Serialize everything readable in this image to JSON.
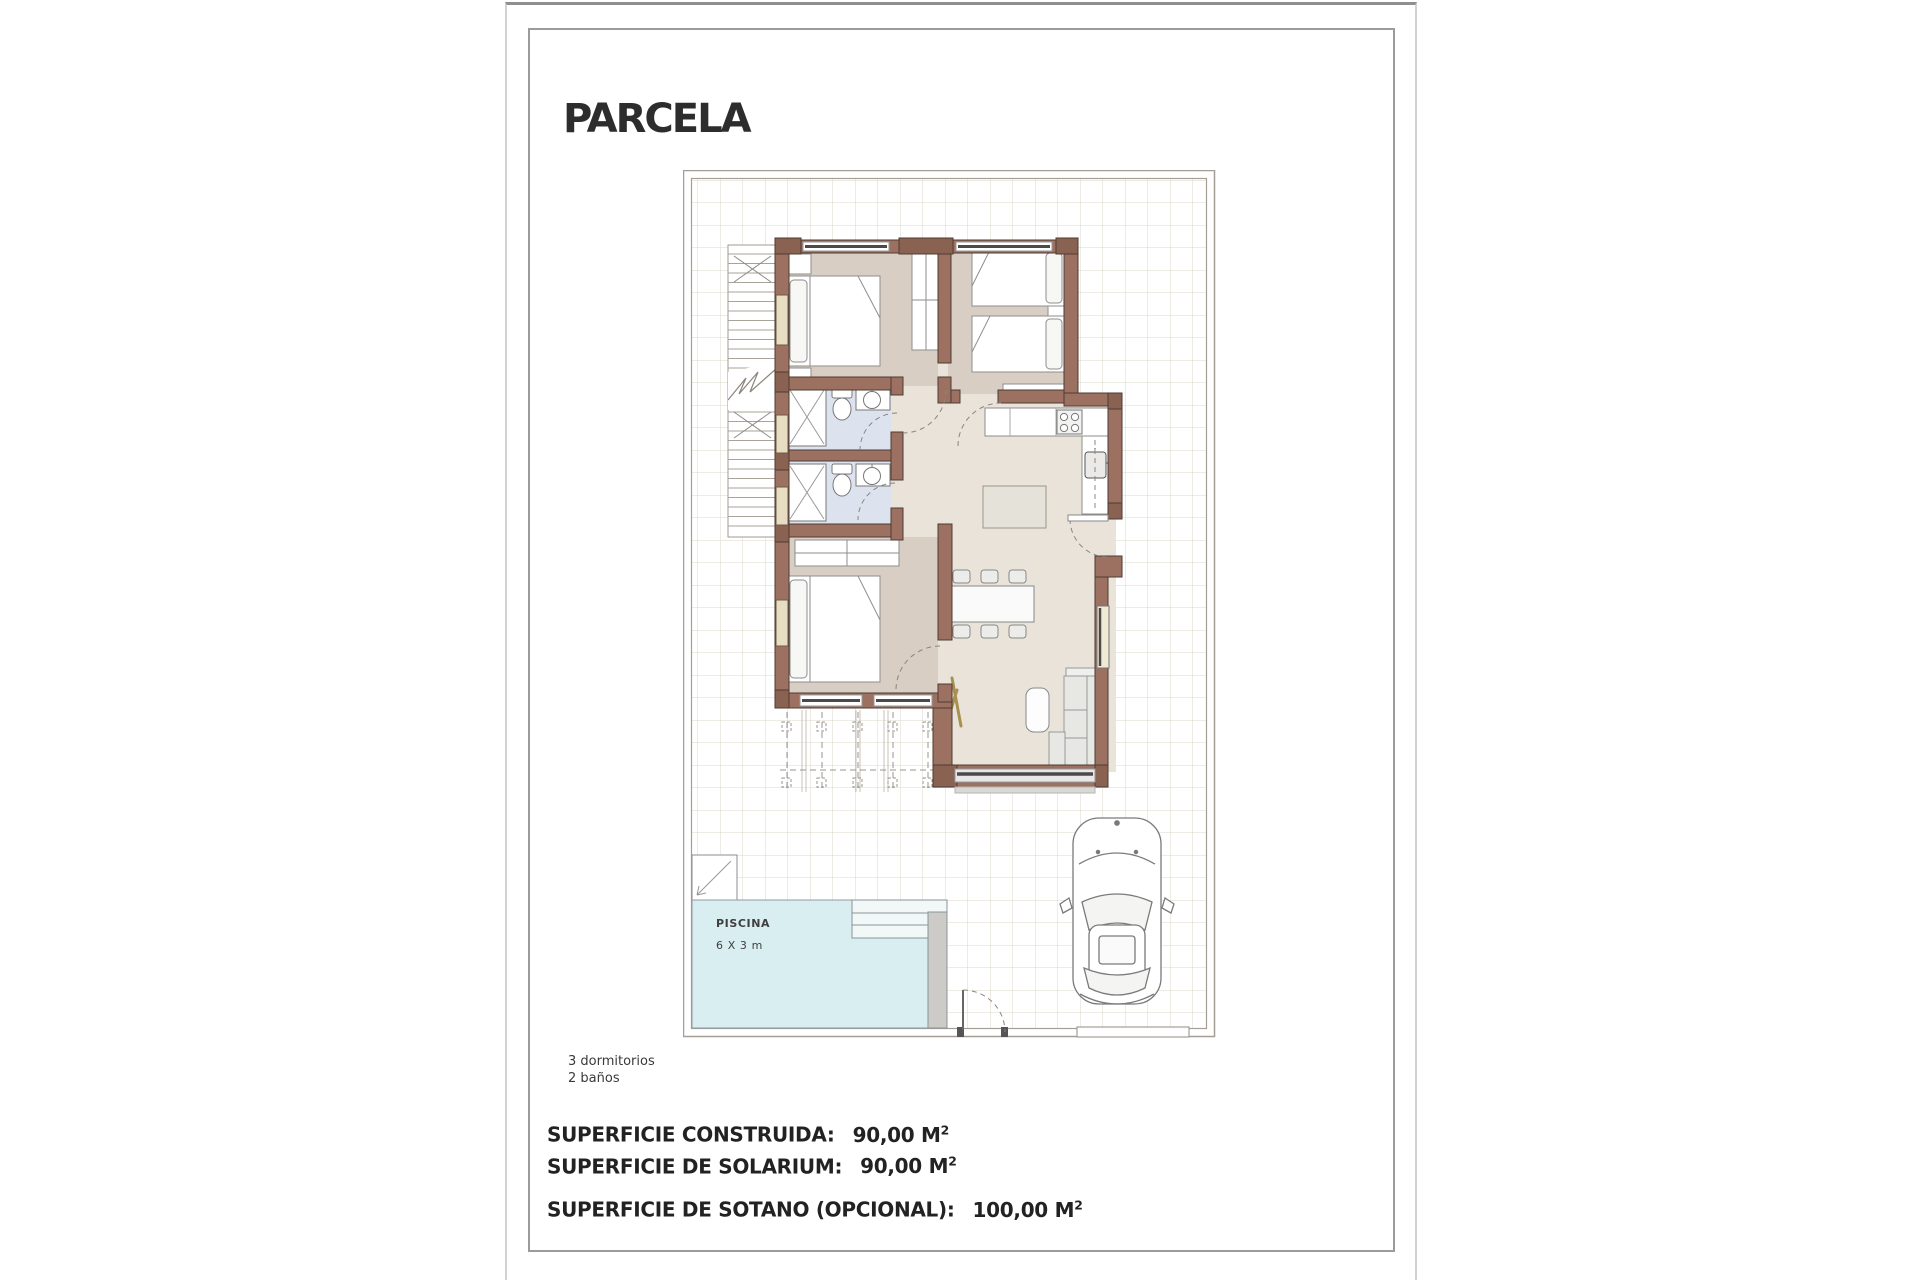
{
  "page": {
    "title": "PARCELA",
    "notes": {
      "line1": "3 dormitorios",
      "line2": "2 baños"
    }
  },
  "plan": {
    "pool": {
      "label": "PISCINA",
      "dimensions": "6 X 3 m"
    }
  },
  "summary": {
    "rows": [
      {
        "label": "SUPERFICIE CONSTRUIDA:",
        "value": "90,00",
        "unit": "M",
        "exponent": "2"
      },
      {
        "label": "SUPERFICIE DE SOLARIUM:",
        "value": "90,00",
        "unit": "M",
        "exponent": "2"
      },
      {
        "label": "SUPERFICIE DE SOTANO (OPCIONAL):",
        "value": "100,00",
        "unit": "M",
        "exponent": "2"
      }
    ]
  },
  "colors": {
    "wall": "#9c7161",
    "wall_dark": "#8a6252",
    "wall_outline": "#4e3b32",
    "bedroom_floor": "#d9cec3",
    "hall_floor": "#e9e3da",
    "bath_floor": "#dde3ee",
    "pool_water": "#d9eef1",
    "grid_line": "#ddd5c9",
    "plot_border": "#a49e94"
  }
}
